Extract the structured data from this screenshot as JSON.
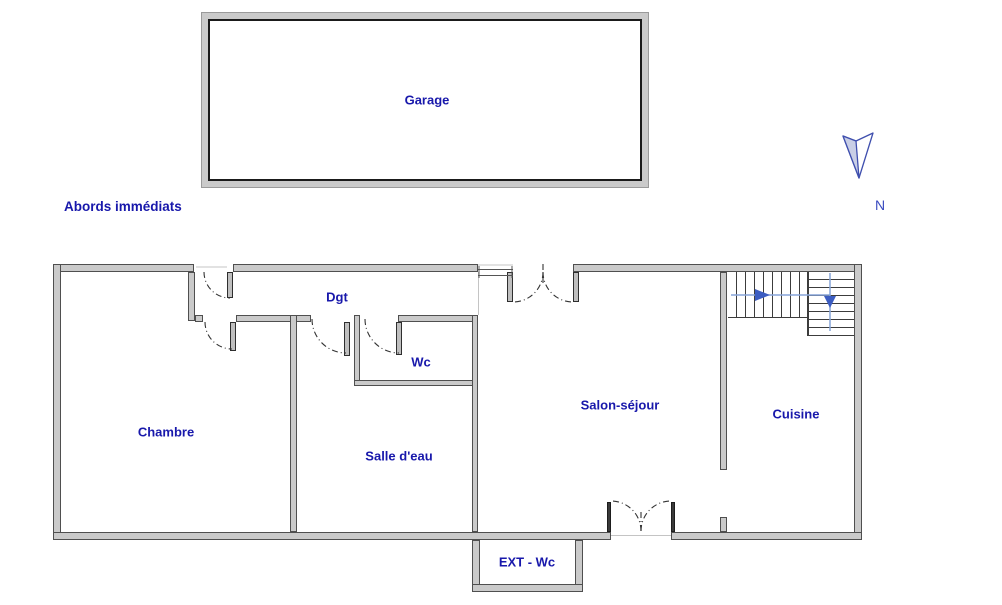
{
  "title": "Abords immédiats",
  "compass": {
    "label": "N",
    "icon": "north-arrow-icon"
  },
  "rooms": {
    "garage": "Garage",
    "chambre": "Chambre",
    "dgt": "Dgt",
    "wc": "Wc",
    "salle_deau": "Salle d'eau",
    "salon_sejour": "Salon-séjour",
    "cuisine": "Cuisine",
    "ext_wc": "EXT - Wc"
  },
  "icons": [
    "north-arrow-icon",
    "stairs-direction-arrows",
    "door-swing-arc"
  ],
  "colors": {
    "label_text": "#1818ab",
    "wall_fill": "#cacaca",
    "wall_edge": "#4f4f4f",
    "stair_route_line": "#86a4d8",
    "stair_route_arrow": "#3c5dc2",
    "compass_outline": "#3f4fae",
    "compass_fill": "#c9cfe6"
  }
}
